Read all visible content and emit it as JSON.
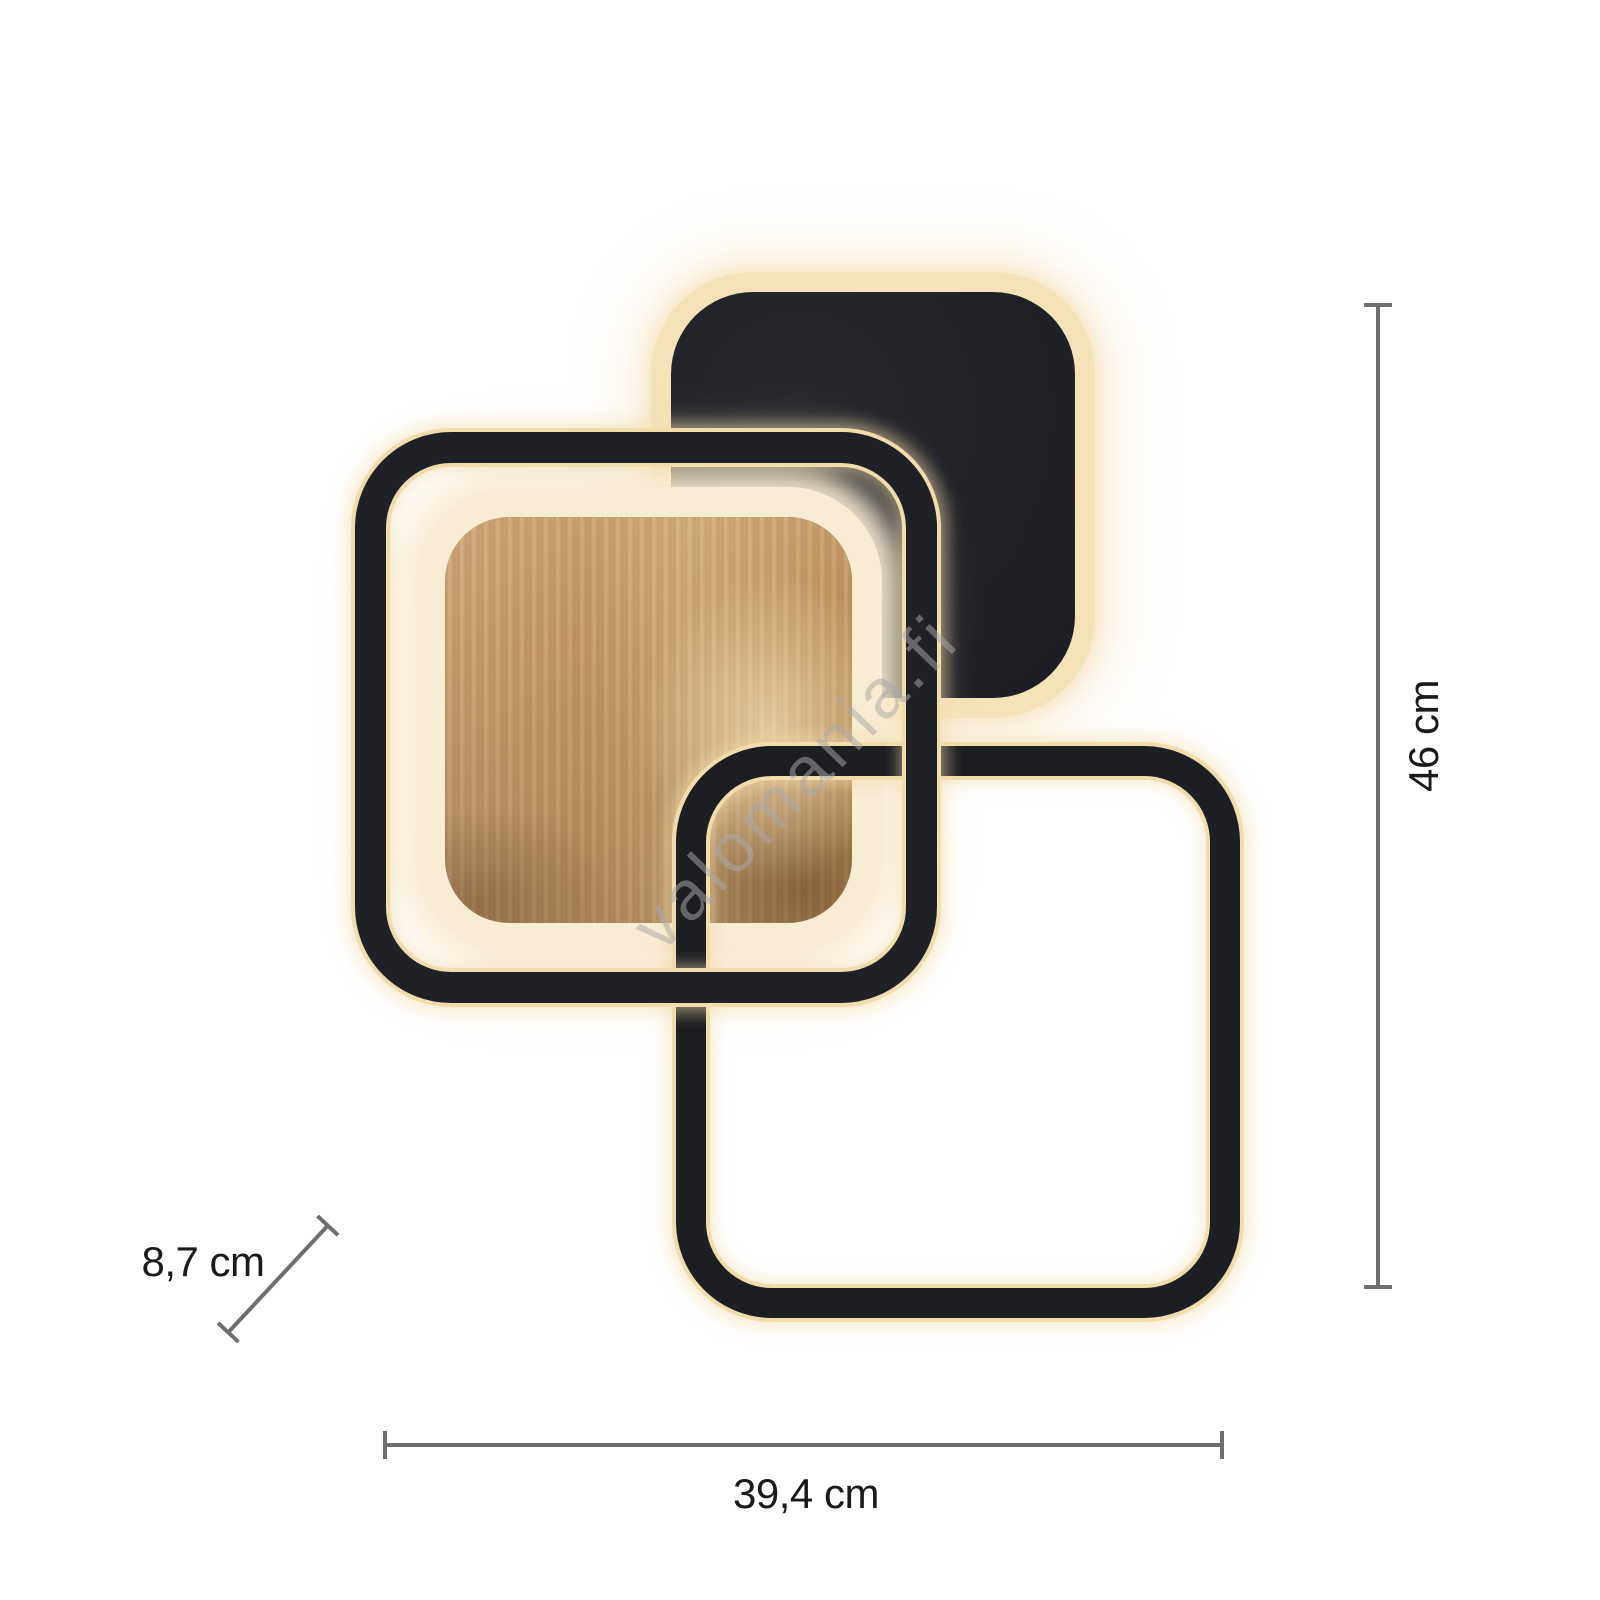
{
  "product": {
    "description": "LED ceiling light with three overlapping rounded squares (black panel, wood panel, two lit open frames)",
    "watermark": "valomania.fi"
  },
  "dimensions": {
    "height": "46 cm",
    "width": "39,4 cm",
    "depth": "8,7 cm"
  },
  "colors": {
    "background": "#ffffff",
    "panel_black": "#212228",
    "frame_black": "#1d1e22",
    "wood_mid": "#c49969",
    "glow_band": "#f5e2b8",
    "glow_line": "#f2dcab",
    "dimension_line": "#6e6e6e",
    "dimension_text": "#1a1a1a",
    "watermark_gray": "#a8a8a8"
  }
}
